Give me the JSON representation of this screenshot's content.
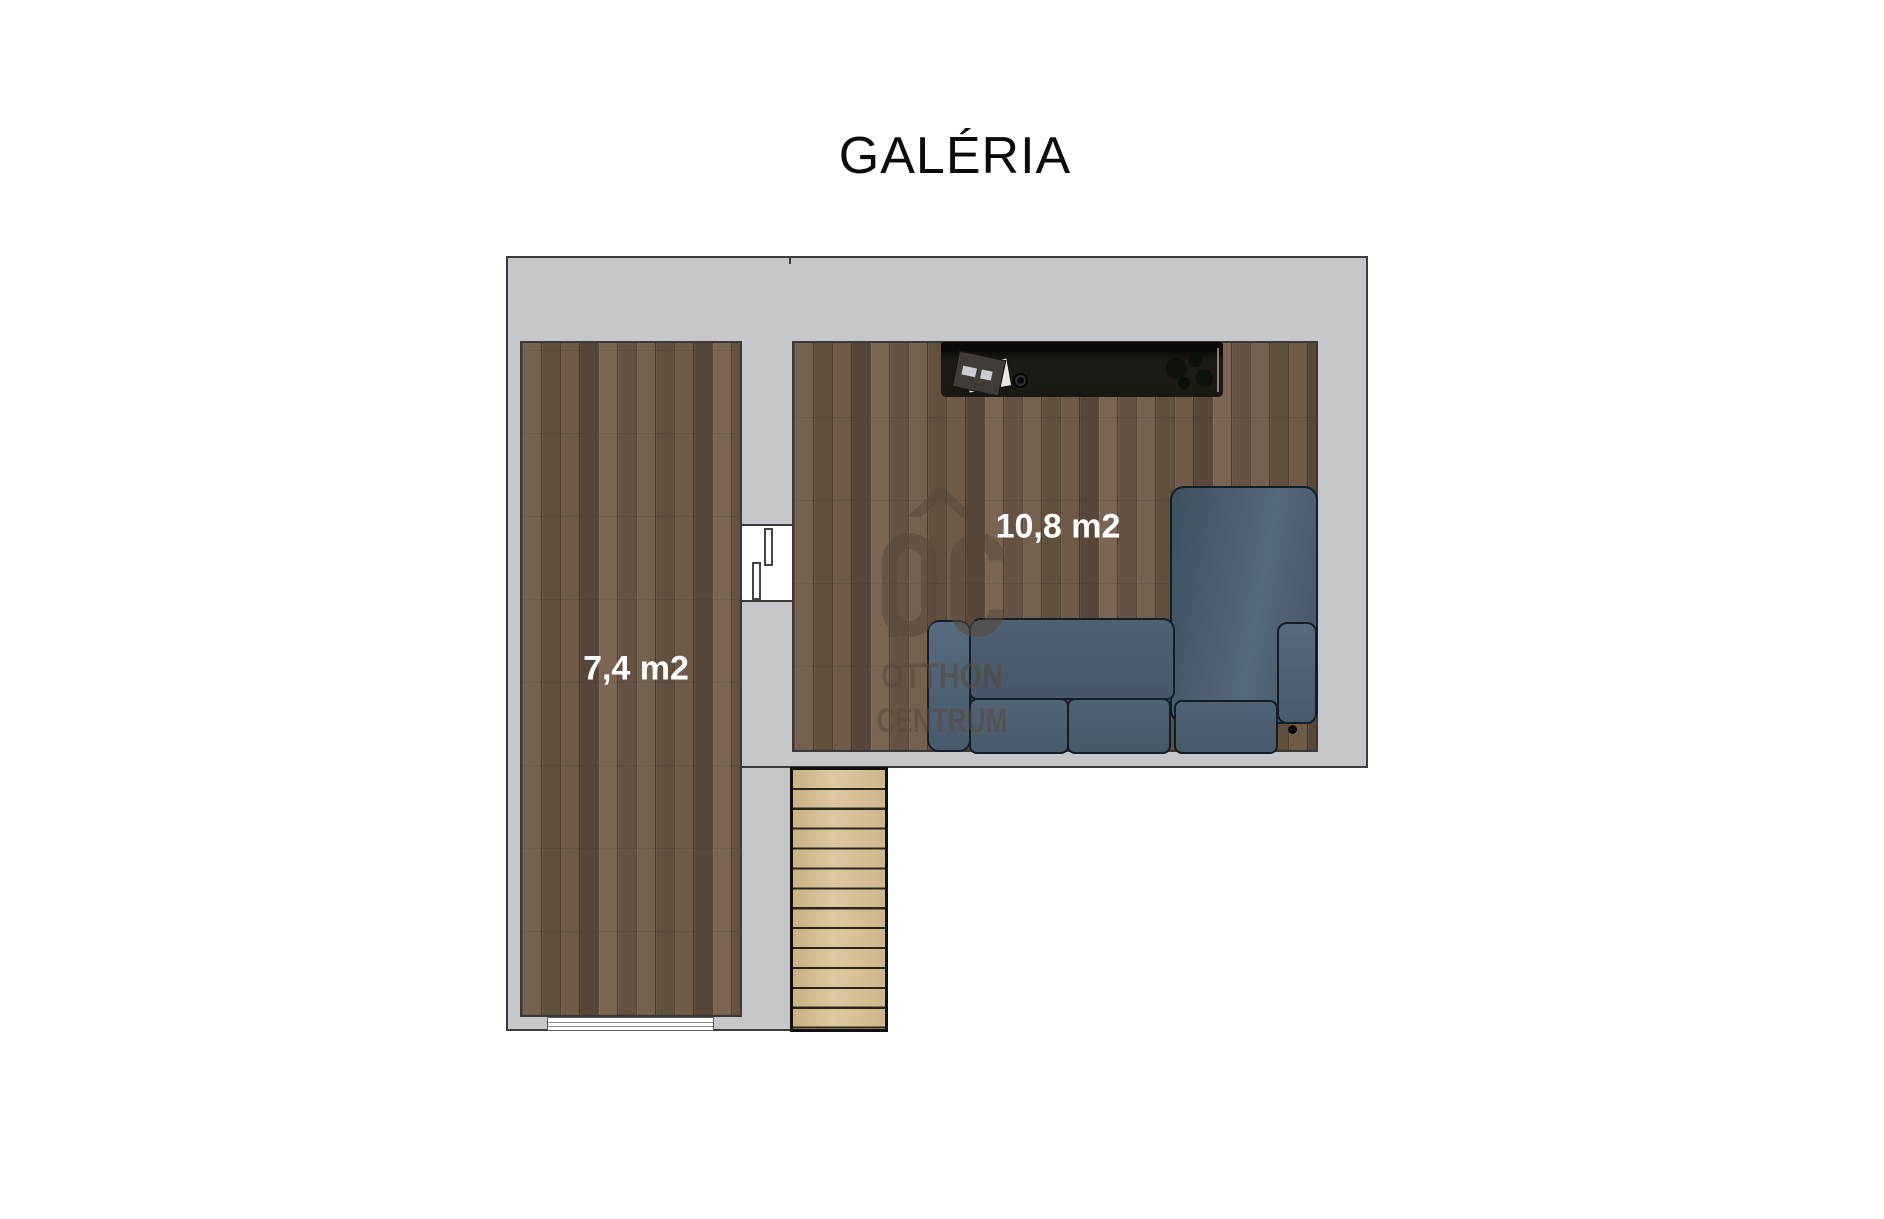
{
  "title": "GALÉRIA",
  "rooms": [
    {
      "id": "galeria-left",
      "area_label": "7,4 m2"
    },
    {
      "id": "galeria-living",
      "area_label": "10,8 m2"
    }
  ],
  "watermark": {
    "logo": "OC",
    "line1": "OTTHON",
    "line2": "CENTRUM"
  },
  "colors": {
    "wall_gray": "#c5c7ca",
    "outline_dark": "#3c3c3e",
    "floor_wood": "#6b5747",
    "stairs_wood": "#d6c095",
    "sofa_blue": "#4a5d6f",
    "desk_black": "#16130f",
    "watermark_brown": "#59483a",
    "label_text": "#ffffff",
    "title_text": "#0c0c0c"
  }
}
